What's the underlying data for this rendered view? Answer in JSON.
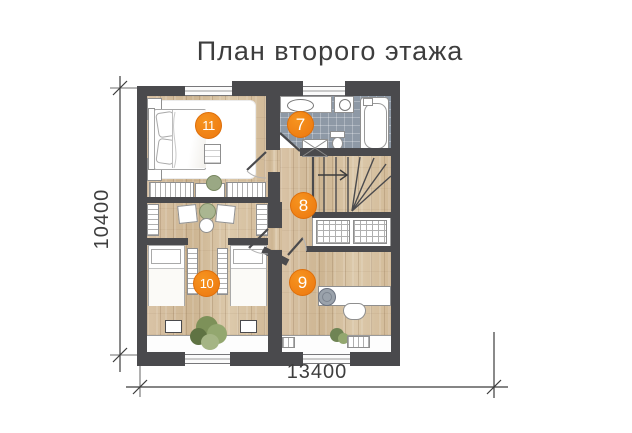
{
  "title": "План второго этажа",
  "dimensions": {
    "width_label": "13400",
    "height_label": "10400"
  },
  "markers": {
    "bathroom": "7",
    "hall": "8",
    "study": "9",
    "children_room": "10",
    "bedroom": "11"
  },
  "colors": {
    "accent_orange": "#ef7e13",
    "wall": "#4a4a4d",
    "wood_floor": "#d7c1a2",
    "tile_floor": "#8e99a6",
    "text": "#3d3d3d",
    "background": "#ffffff"
  }
}
